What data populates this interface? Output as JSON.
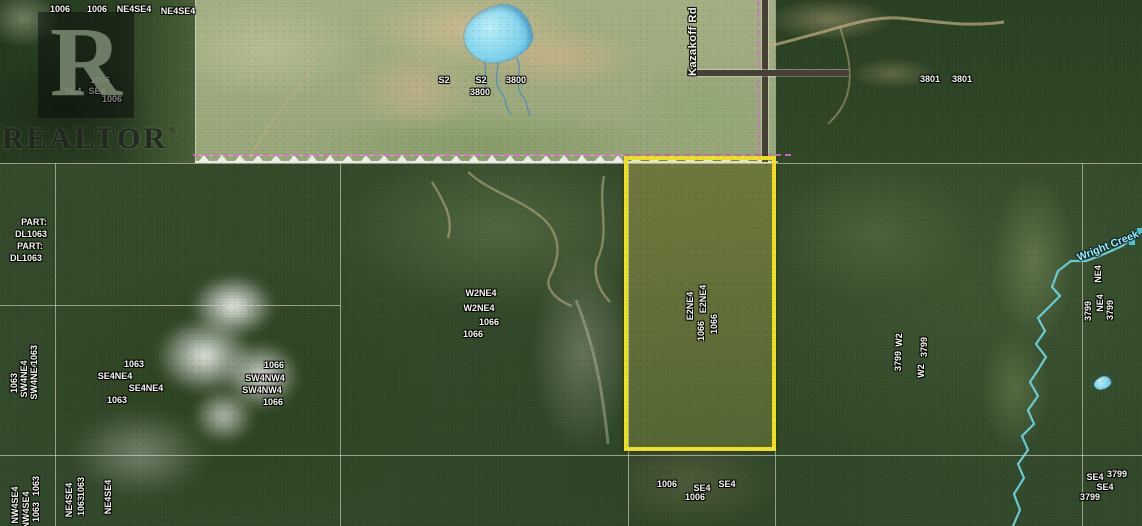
{
  "watermark": {
    "logo_letter": "R",
    "brand": "REALTOR",
    "registered": "®"
  },
  "colors": {
    "parcel_highlight": "#f2e41f",
    "survey_line": "#da6ccc",
    "water_line": "#6fd3de",
    "grid_line": "#dcded2",
    "trail": "#c3b085",
    "label_text": "#f8f8f2"
  },
  "map": {
    "road": {
      "label": "Kazakoff Rd"
    },
    "creek": {
      "label": "Wright Creek"
    },
    "fence": {
      "x": 195,
      "y": 155,
      "width": 583,
      "spacing": 18
    },
    "gridlines": [
      {
        "x": 195,
        "y": 0,
        "w": 1,
        "h": 163
      },
      {
        "x": 775,
        "y": 0,
        "w": 1,
        "h": 526
      },
      {
        "x": 55,
        "y": 163,
        "w": 1,
        "h": 363
      },
      {
        "x": 340,
        "y": 163,
        "w": 1,
        "h": 363
      },
      {
        "x": 628,
        "y": 163,
        "w": 1,
        "h": 363
      },
      {
        "x": 1082,
        "y": 163,
        "w": 1,
        "h": 363
      },
      {
        "x": 0,
        "y": 163,
        "w": 1142,
        "h": 1
      },
      {
        "x": 0,
        "y": 305,
        "w": 340,
        "h": 1
      },
      {
        "x": 0,
        "y": 455,
        "w": 1142,
        "h": 1
      }
    ],
    "labels": [
      {
        "text": "1006",
        "x": 60,
        "y": 9
      },
      {
        "text": "1006",
        "x": 97,
        "y": 9
      },
      {
        "text": "NE4SE4",
        "x": 134,
        "y": 9
      },
      {
        "text": "NE4SE4",
        "x": 178,
        "y": 11
      },
      {
        "text": "1006",
        "x": 100,
        "y": 80
      },
      {
        "text": "SE4",
        "x": 73,
        "y": 91
      },
      {
        "text": "SE4",
        "x": 97,
        "y": 91
      },
      {
        "text": "1006",
        "x": 112,
        "y": 99
      },
      {
        "text": "S2",
        "x": 444,
        "y": 80
      },
      {
        "text": "S2",
        "x": 481,
        "y": 80
      },
      {
        "text": "3800",
        "x": 480,
        "y": 92
      },
      {
        "text": "3800",
        "x": 516,
        "y": 80
      },
      {
        "text": "3801",
        "x": 930,
        "y": 79
      },
      {
        "text": "3801",
        "x": 962,
        "y": 79
      },
      {
        "text": "PART:",
        "x": 34,
        "y": 222
      },
      {
        "text": "DL1063",
        "x": 31,
        "y": 234
      },
      {
        "text": "PART:",
        "x": 30,
        "y": 246
      },
      {
        "text": "DL1063",
        "x": 26,
        "y": 258
      },
      {
        "text": "W2NE4",
        "x": 481,
        "y": 293
      },
      {
        "text": "W2NE4",
        "x": 479,
        "y": 308
      },
      {
        "text": "1066",
        "x": 489,
        "y": 322
      },
      {
        "text": "1066",
        "x": 473,
        "y": 334
      },
      {
        "text": "1063",
        "x": 134,
        "y": 364
      },
      {
        "text": "SE4NE4",
        "x": 115,
        "y": 376
      },
      {
        "text": "SE4NE4",
        "x": 146,
        "y": 388
      },
      {
        "text": "1063",
        "x": 117,
        "y": 400
      },
      {
        "text": "1066",
        "x": 274,
        "y": 365
      },
      {
        "text": "SW4NW4",
        "x": 265,
        "y": 378
      },
      {
        "text": "SW4NW4",
        "x": 262,
        "y": 390
      },
      {
        "text": "1066",
        "x": 273,
        "y": 402
      },
      {
        "text": "1006",
        "x": 667,
        "y": 484
      },
      {
        "text": "SE4",
        "x": 702,
        "y": 488
      },
      {
        "text": "1006",
        "x": 695,
        "y": 497
      },
      {
        "text": "SE4",
        "x": 727,
        "y": 484
      },
      {
        "text": "SE4",
        "x": 1095,
        "y": 477
      },
      {
        "text": "3799",
        "x": 1117,
        "y": 474
      },
      {
        "text": "SE4",
        "x": 1105,
        "y": 487
      },
      {
        "text": "3799",
        "x": 1090,
        "y": 497
      },
      {
        "text": "E2NE4",
        "x": 690,
        "y": 306,
        "rot": -90
      },
      {
        "text": "1066",
        "x": 701,
        "y": 331,
        "rot": -90
      },
      {
        "text": "E2NE4",
        "x": 703,
        "y": 299,
        "rot": -90
      },
      {
        "text": "1066",
        "x": 714,
        "y": 324,
        "rot": -90
      },
      {
        "text": "1063",
        "x": 14,
        "y": 383,
        "rot": -90
      },
      {
        "text": "SW4NE4",
        "x": 24,
        "y": 379,
        "rot": -90
      },
      {
        "text": "SW4NE4",
        "x": 34,
        "y": 381,
        "rot": -90
      },
      {
        "text": "1063",
        "x": 34,
        "y": 355,
        "rot": -90
      },
      {
        "text": "NW4SE4",
        "x": 15,
        "y": 505,
        "rot": -90
      },
      {
        "text": "NW4SE4",
        "x": 26,
        "y": 510,
        "rot": -90
      },
      {
        "text": "1063",
        "x": 36,
        "y": 512,
        "rot": -90
      },
      {
        "text": "1063",
        "x": 36,
        "y": 486,
        "rot": -90
      },
      {
        "text": "NE4SE4",
        "x": 69,
        "y": 500,
        "rot": -90
      },
      {
        "text": "1063",
        "x": 81,
        "y": 506,
        "rot": -90
      },
      {
        "text": "1063",
        "x": 81,
        "y": 487,
        "rot": -90
      },
      {
        "text": "NE4SE4",
        "x": 108,
        "y": 497,
        "rot": -90
      },
      {
        "text": "W2",
        "x": 899,
        "y": 340,
        "rot": -90
      },
      {
        "text": "3799",
        "x": 898,
        "y": 361,
        "rot": -90
      },
      {
        "text": "3799",
        "x": 924,
        "y": 347,
        "rot": -90
      },
      {
        "text": "W2",
        "x": 921,
        "y": 371,
        "rot": -90
      },
      {
        "text": "NE4",
        "x": 1098,
        "y": 274,
        "rot": -90
      },
      {
        "text": "NE4",
        "x": 1100,
        "y": 303,
        "rot": -90
      },
      {
        "text": "3799",
        "x": 1088,
        "y": 311,
        "rot": -90
      },
      {
        "text": "3799",
        "x": 1110,
        "y": 310,
        "rot": -90
      },
      {
        "text": "Kazakoff Rd",
        "x": 768,
        "y": 73,
        "rot": -90,
        "cls": "road"
      },
      {
        "text": "Wright Creek",
        "x": 1108,
        "y": 246,
        "rot": -22,
        "cls": "creek"
      }
    ],
    "paths": {
      "creek": "M1142,231 L1122,246 L1102,255 L1086,261 L1071,261 L1058,271 L1052,287 L1060,296 L1048,308 L1038,318 L1045,331 L1036,344 L1046,357 L1038,370 L1030,382 L1038,396 L1028,410 L1034,424 L1022,436 L1028,450 L1018,464 L1024,478 L1014,494 L1020,510 L1013,526",
      "drainage1": "M497,56 C501,68 491,80 501,92 C507,99 504,108 512,115",
      "drainage2": "M517,58 C523,72 513,85 523,97 C528,103 526,110 531,116",
      "drainage3": "M484,60 C488,72 482,82 488,94",
      "trail_ne": "M770,46 C800,38 820,33 840,27 C862,21 880,17 898,18 C928,20 962,28 1004,22",
      "trail_ne2": "M840,27 C848,52 854,76 846,98 C842,110 834,118 828,124",
      "cut1": "M468,172 C490,192 518,198 540,216 C560,232 562,254 550,276 C544,288 556,300 572,306",
      "cut2": "M604,176 C598,206 610,232 598,258 C592,272 598,290 610,302",
      "cut3": "M432,182 C444,202 454,218 448,238",
      "edge_trail": "M576,300 C592,340 602,382 608,444",
      "field_trail": "M250,158 C264,130 284,106 302,82 C312,68 318,52 322,38"
    }
  }
}
